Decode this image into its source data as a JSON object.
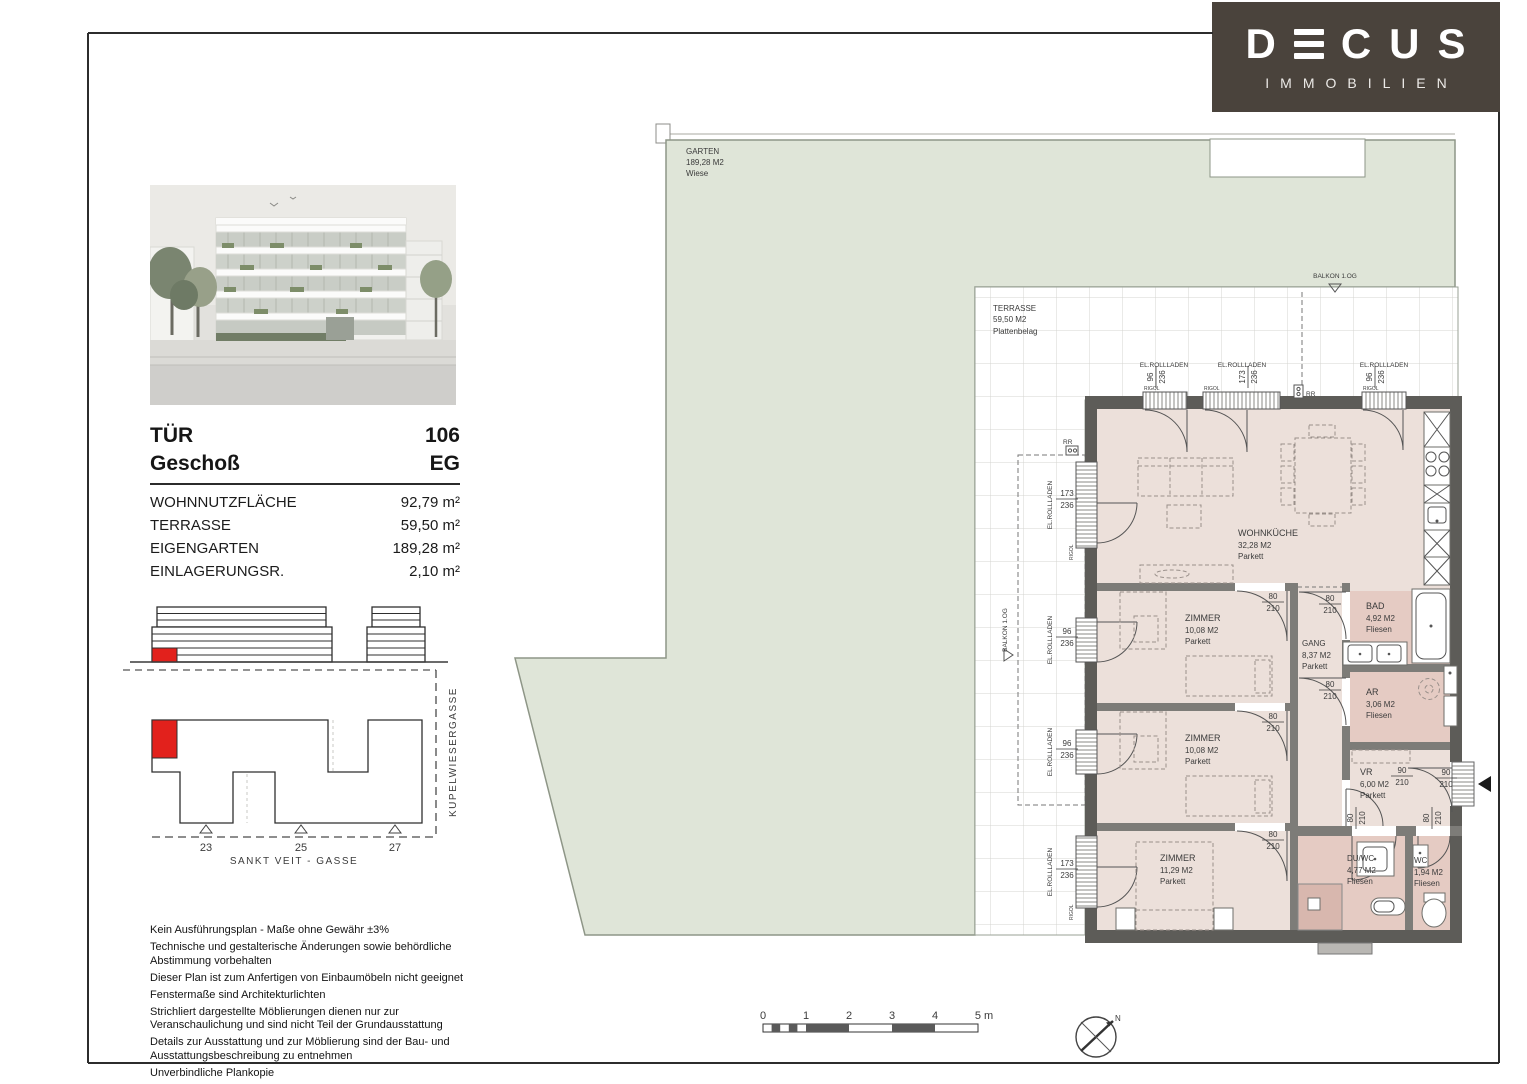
{
  "brand": {
    "name": "DECUS",
    "letters": [
      "D",
      "C",
      "U",
      "S"
    ],
    "tagline": "IMMOBILIEN"
  },
  "unit_info": {
    "door_label": "TÜR",
    "door_value": "106",
    "floor_label": "Geschoß",
    "floor_value": "EG",
    "areas": [
      {
        "label": "WOHNNUTZFLÄCHE",
        "value": "92,79 m²"
      },
      {
        "label": "TERRASSE",
        "value": "59,50 m²"
      },
      {
        "label": "EIGENGARTEN",
        "value": "189,28 m²"
      },
      {
        "label": "EINLAGERUNGSR.",
        "value": "2,10 m²"
      }
    ]
  },
  "site_plan": {
    "street_bottom": "SANKT VEIT - GASSE",
    "street_right": "KUPELWIESERGASSE",
    "house_numbers": [
      "23",
      "25",
      "27"
    ]
  },
  "disclaimer": [
    "Kein Ausführungsplan - Maße ohne Gewähr ±3%",
    "Technische und gestalterische Änderungen sowie behördliche Abstimmung vorbehalten",
    "Dieser Plan ist zum Anfertigen von Einbaumöbeln nicht geeignet",
    "Fenstermaße sind Architekturlichten",
    "Strichliert dargestellte Möblierungen dienen nur zur Veranschaulichung und sind nicht Teil der Grundausstattung",
    "Details zur Ausstattung und zur Möblierung sind der Bau- und Ausstattungsbeschreibung zu entnehmen",
    "Unverbindliche Plankopie"
  ],
  "plan": {
    "garten": {
      "name": "GARTEN",
      "area": "189,28 M2",
      "surface": "Wiese"
    },
    "terrasse": {
      "name": "TERRASSE",
      "area": "59,50 M2",
      "surface": "Plattenbelag"
    },
    "balkon_above": "BALKON 1.OG",
    "balkon_left": "BALKON 1.OG",
    "rooms": {
      "wohnkueche": {
        "name": "WOHNKÜCHE",
        "area": "32,28 M2",
        "floor": "Parkett"
      },
      "zimmer1": {
        "name": "ZIMMER",
        "area": "10,08 M2",
        "floor": "Parkett"
      },
      "zimmer2": {
        "name": "ZIMMER",
        "area": "10,08 M2",
        "floor": "Parkett"
      },
      "zimmer3": {
        "name": "ZIMMER",
        "area": "11,29 M2",
        "floor": "Parkett"
      },
      "gang": {
        "name": "GANG",
        "area": "8,37 M2",
        "floor": "Parkett"
      },
      "bad": {
        "name": "BAD",
        "area": "4,92 M2",
        "floor": "Fliesen"
      },
      "ar": {
        "name": "AR",
        "area": "3,06 M2",
        "floor": "Fliesen"
      },
      "vr": {
        "name": "VR",
        "area": "6,00 M2",
        "floor": "Parkett"
      },
      "duwc": {
        "name": "DU/WC",
        "area": "4,77 M2",
        "floor": "Fliesen"
      },
      "wc": {
        "name": "WC",
        "area": "1,94 M2",
        "floor": "Fliesen"
      }
    },
    "annotations": {
      "rollladen": "EL.ROLLLADEN",
      "rigol": "RIGOL",
      "rr": "RR"
    },
    "dims": {
      "d80": "80",
      "d90": "90",
      "d96": "96",
      "d173": "173",
      "d210": "210",
      "d236": "236"
    }
  },
  "scale_bar": {
    "ticks": [
      "0",
      "1",
      "2",
      "3",
      "4"
    ],
    "end_label": "5 m"
  },
  "compass": {
    "north": "N"
  },
  "colors": {
    "logo_bg": "#4a433c",
    "accent_red": "#e2211c",
    "garden_green": "#dfe5d8",
    "floor_pink": "#ece0da",
    "wet_pink": "#e5cbc3",
    "shower_pink": "#d8b7ae",
    "wall_dark": "#5d5c58",
    "wall_mid": "#7d7c78"
  }
}
